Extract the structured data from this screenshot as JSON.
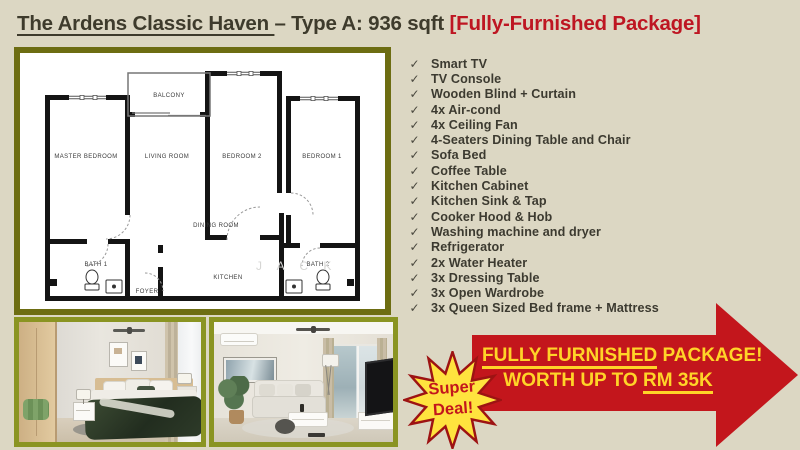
{
  "title": {
    "name": "The Ardens Classic Haven ",
    "type": "– Type A: 936 sqft ",
    "package": "[Fully-Furnished Package]"
  },
  "floorplan": {
    "rooms": {
      "master_bedroom": "MASTER BEDROOM",
      "living_room": "LIVING ROOM",
      "bedroom2": "BEDROOM 2",
      "bedroom1": "BEDROOM 1",
      "balcony": "BALCONY",
      "dining_room": "DINING ROOM",
      "kitchen": "KITCHEN",
      "bath1": "BATH 1",
      "bath2": "BATH 2",
      "foyer": "FOYER"
    },
    "watermark": "J A C K"
  },
  "checklist": {
    "check_glyph": "✓",
    "items": [
      "Smart TV",
      "TV Console",
      "Wooden Blind + Curtain",
      "4x Air-cond",
      "4x Ceiling Fan",
      "4-Seaters Dining Table and Chair",
      "Sofa Bed",
      "Coffee Table",
      "Kitchen Cabinet",
      "Kitchen Sink & Tap",
      "Cooker Hood & Hob",
      "Washing machine and dryer",
      "Refrigerator",
      "2x Water Heater",
      "3x Dressing Table",
      "3x Open Wardrobe",
      "3x Queen Sized Bed frame + Mattress"
    ]
  },
  "badge": {
    "line1": "Super",
    "line2": "Deal!"
  },
  "banner": {
    "line1_underlined": "FULLY FURNISHED",
    "line1_rest": " PACKAGE!",
    "line2_prefix": "WORTH UP TO ",
    "line2_underlined": "RM 35K"
  },
  "colors": {
    "background": "#dcd7c3",
    "title_dark": "#3e3b2c",
    "accent_red": "#be1622",
    "arrow_red": "#c3161c",
    "banner_yellow": "#ffd428",
    "starburst_yellow": "#ffe33e",
    "plan_border_olive": "#6d6d12",
    "photo_border_olive": "#8a9422"
  }
}
